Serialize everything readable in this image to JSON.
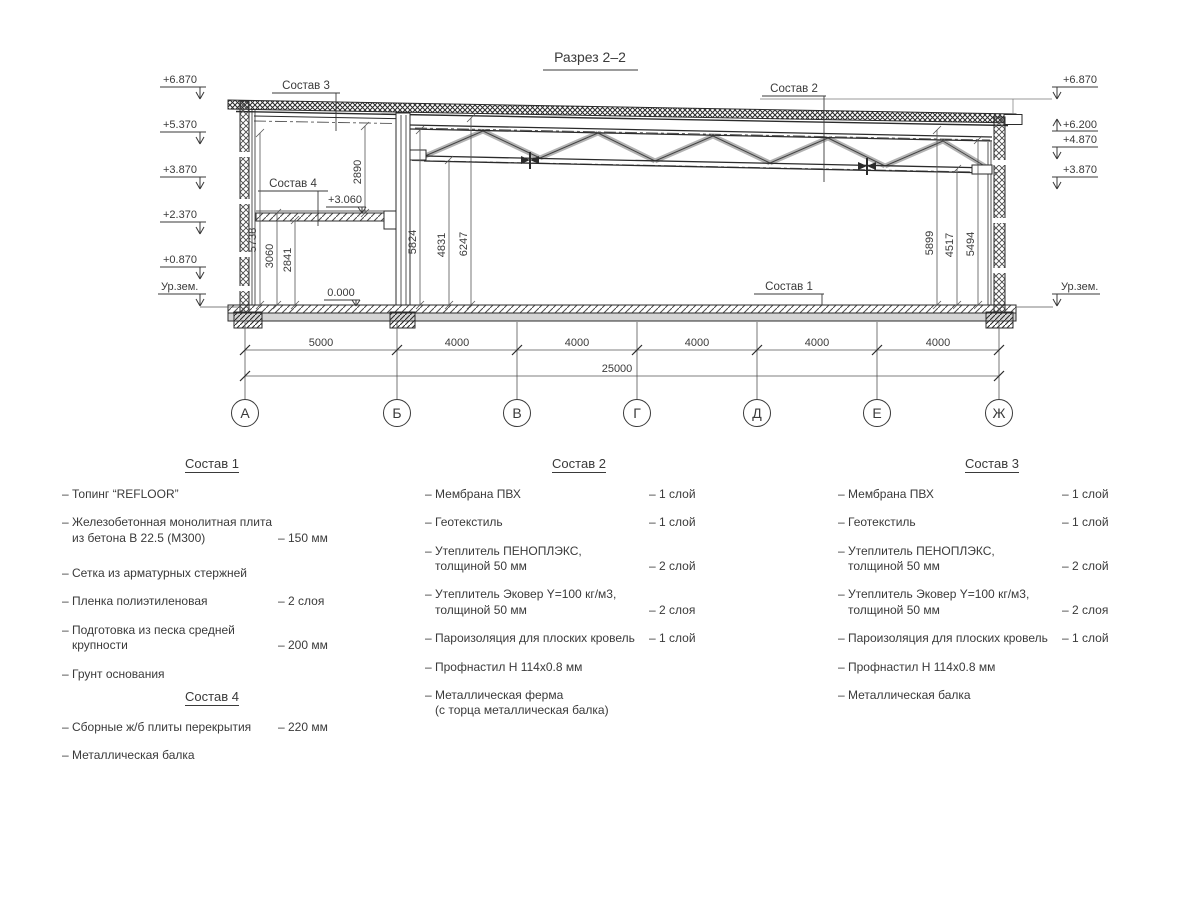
{
  "title": "Разрез 2–2",
  "drawing": {
    "elevations_left": [
      "+6.870",
      "+5.370",
      "+3.870",
      "+2.370",
      "+0.870",
      "Ур.зем."
    ],
    "elevations_right": [
      "+6.870",
      "+6.200",
      "+4.870",
      "+3.870",
      "Ур.зем."
    ],
    "level_marks": {
      "zero": "0.000",
      "mezzanine": "+3.060"
    },
    "leaders": {
      "s1": "Состав 1",
      "s2": "Состав 2",
      "s3": "Состав 3",
      "s4": "Состав 4"
    },
    "vertical_dims": [
      "5738",
      "3060",
      "2841",
      "2890",
      "5824",
      "4831",
      "6247",
      "5899",
      "4517",
      "5494"
    ],
    "axes": [
      "А",
      "Б",
      "В",
      "Г",
      "Д",
      "Е",
      "Ж"
    ],
    "span_dims": [
      "5000",
      "4000",
      "4000",
      "4000",
      "4000",
      "4000"
    ],
    "total_dim": "25000"
  },
  "compositions": [
    {
      "title": "Состав 1",
      "items": [
        {
          "text": "– Топинг “REFLOOR”",
          "text2": "",
          "value": ""
        },
        {
          "text": "– Железобетонная  монолитная плита",
          "text2": "из бетона В 22.5 (М300)",
          "value": "– 150 мм"
        },
        {
          "text": "– Сетка из арматурных стержней",
          "text2": "",
          "value": ""
        },
        {
          "text": "– Пленка полиэтиленовая",
          "text2": "",
          "value": "–  2 слоя"
        },
        {
          "text": "– Подготовка из песка средней",
          "text2": "крупности",
          "value": "– 200 мм"
        },
        {
          "text": "– Грунт основания",
          "text2": "",
          "value": ""
        }
      ]
    },
    {
      "title": "Состав 2",
      "items": [
        {
          "text": "– Мембрана ПВХ",
          "text2": "",
          "value": "– 1 слой"
        },
        {
          "text": "– Геотекстиль",
          "text2": "",
          "value": "– 1 слой"
        },
        {
          "text": "– Утеплитель ПЕНОПЛЭКС,",
          "text2": "толщиной 50 мм",
          "value": "– 2 слой"
        },
        {
          "text": "– Утеплитель Эковер Y=100 кг/м3,",
          "text2": "толщиной 50 мм",
          "value": "– 2 слоя"
        },
        {
          "text": "– Пароизоляция для плоских кровель",
          "text2": "",
          "value": "– 1 слой"
        },
        {
          "text": "– Профнастил Н 114х0.8 мм",
          "text2": "",
          "value": ""
        },
        {
          "text": "– Металлическая ферма",
          "text2": "(с торца металлическая балка)",
          "value": ""
        }
      ]
    },
    {
      "title": "Состав 3",
      "items": [
        {
          "text": "– Мембрана ПВХ",
          "text2": "",
          "value": "– 1 слой"
        },
        {
          "text": "– Геотекстиль",
          "text2": "",
          "value": "– 1 слой"
        },
        {
          "text": "– Утеплитель ПЕНОПЛЭКС,",
          "text2": "толщиной 50 мм",
          "value": "– 2 слой"
        },
        {
          "text": "– Утеплитель Эковер Y=100 кг/м3,",
          "text2": "толщиной 50 мм",
          "value": "– 2 слоя"
        },
        {
          "text": "– Пароизоляция для плоских кровель",
          "text2": "",
          "value": "– 1 слой"
        },
        {
          "text": "– Профнастил Н 114х0.8 мм",
          "text2": "",
          "value": ""
        },
        {
          "text": "– Металлическая балка",
          "text2": "",
          "value": ""
        }
      ]
    },
    {
      "title": "Состав 4",
      "items": [
        {
          "text": "– Сборные ж/б плиты перекрытия",
          "text2": "",
          "value": "– 220 мм"
        },
        {
          "text": "– Металлическая балка",
          "text2": "",
          "value": ""
        }
      ]
    }
  ]
}
